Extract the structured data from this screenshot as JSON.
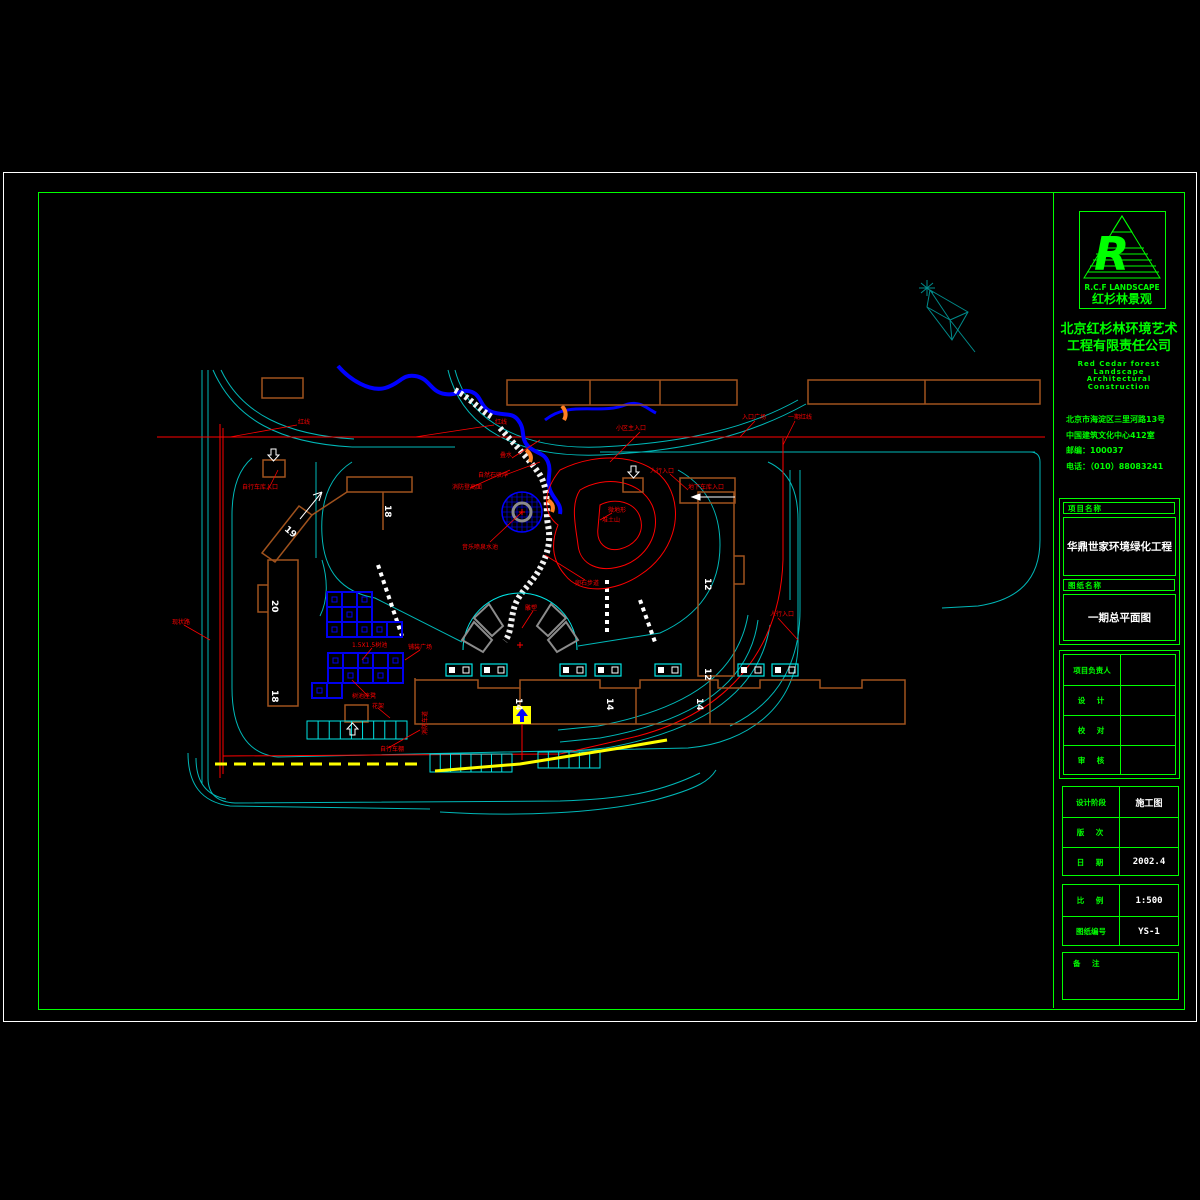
{
  "titleblock": {
    "brand_en": "R.C.F LANDSCAPE",
    "brand_cn": "红杉林景观",
    "company_line1": "北京红杉林环境艺术",
    "company_line2": "工程有限责任公司",
    "company_en1": "Red Cedar forest Landscape",
    "company_en2": "Architectural Construction",
    "address1": "北京市海淀区三里河路13号",
    "address2": "中国建筑文化中心412室",
    "address3": "邮编：100037",
    "address4": "电话：（010）88083241",
    "project_label": "项目名称",
    "project_name": "华鼎世家环境绿化工程",
    "drawing_label": "图纸名称",
    "drawing_name": "一期总平面图",
    "personnel": [
      {
        "label": "项目负责人",
        "value": ""
      },
      {
        "label": "设　计",
        "value": ""
      },
      {
        "label": "校　对",
        "value": ""
      },
      {
        "label": "审　核",
        "value": ""
      }
    ],
    "stage": [
      {
        "label": "设计阶段",
        "value": "施工图"
      },
      {
        "label": "版　次",
        "value": ""
      },
      {
        "label": "日　期",
        "value": "2002.4"
      }
    ],
    "scale": [
      {
        "label": "比　例",
        "value": "1:500"
      },
      {
        "label": "图纸编号",
        "value": "YS-1"
      }
    ],
    "notes_label": "备　注"
  },
  "plan": {
    "buildings": {
      "b18_top": "18",
      "b19": "19",
      "b20": "20",
      "b18_left": "18",
      "b14_1": "14",
      "b14_2": "14",
      "b14_3": "14",
      "b12_1": "12",
      "b12_2": "12"
    },
    "labels": {
      "redline1": "红线",
      "redline2": "红线",
      "redline3": "一期红线",
      "main_entry": "小区主入口",
      "entry_plaza": "入口广场",
      "garage_entry": "地下车库入口",
      "ped_entry": "人行入口",
      "ped_entry2": "人行入口",
      "bike_garage": "自行车库入口",
      "fire_lane": "消防登高面",
      "cascade": "叠水",
      "stone_bank": "自然石驳岸",
      "fountain": "音乐喷泉水池",
      "mound1": "微地形",
      "mound2": "堆土山",
      "pebble_path": "卵石步道",
      "exist_road": "现状路",
      "tree_pool": "1.5X1.5树池",
      "plaza_paving": "铺装广场",
      "tree_bench": "树池座凳",
      "pergola": "花架",
      "bike_shed": "自行车棚",
      "sculpture": "雕塑",
      "fire_road": "消防车道"
    }
  },
  "colors": {
    "frame_green": "#00ff00",
    "road_cyan": "#00b8b8",
    "detail_cyan": "#00e5e5",
    "red": "#ff0000",
    "blue": "#0000ff",
    "building_brown": "#a0521d",
    "yellow": "#ffff00",
    "gray": "#8c8c8c",
    "orange": "#ff7f24",
    "teal": "#008b8b"
  }
}
